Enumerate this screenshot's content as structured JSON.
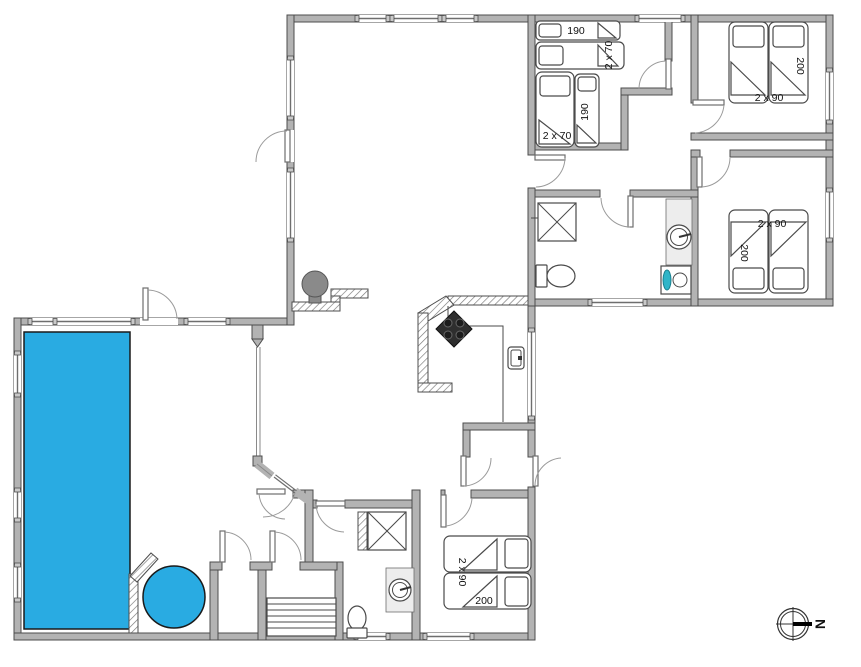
{
  "colors": {
    "pool": "#29abe2",
    "wall_fill": "#b3b3b3",
    "wall_stroke": "#4d4d4d",
    "stove": "#2e2e2e",
    "washer_accent": "#2fb5c8",
    "fireplace": "#8a8a8a",
    "counter": "#ededed"
  },
  "compass": {
    "label": "N"
  },
  "rooms": {
    "bedroom_top_middle": {
      "bed_labels": [
        "190",
        "2 x 70",
        "2 x 70",
        "190"
      ]
    },
    "bedroom_top_right": {
      "bed_labels": [
        "200",
        "2 x 90"
      ]
    },
    "bedroom_middle_right": {
      "bed_labels": [
        "2 x 90",
        "200"
      ]
    },
    "bedroom_bottom": {
      "bed_labels": [
        "2 x 90",
        "200"
      ]
    }
  }
}
